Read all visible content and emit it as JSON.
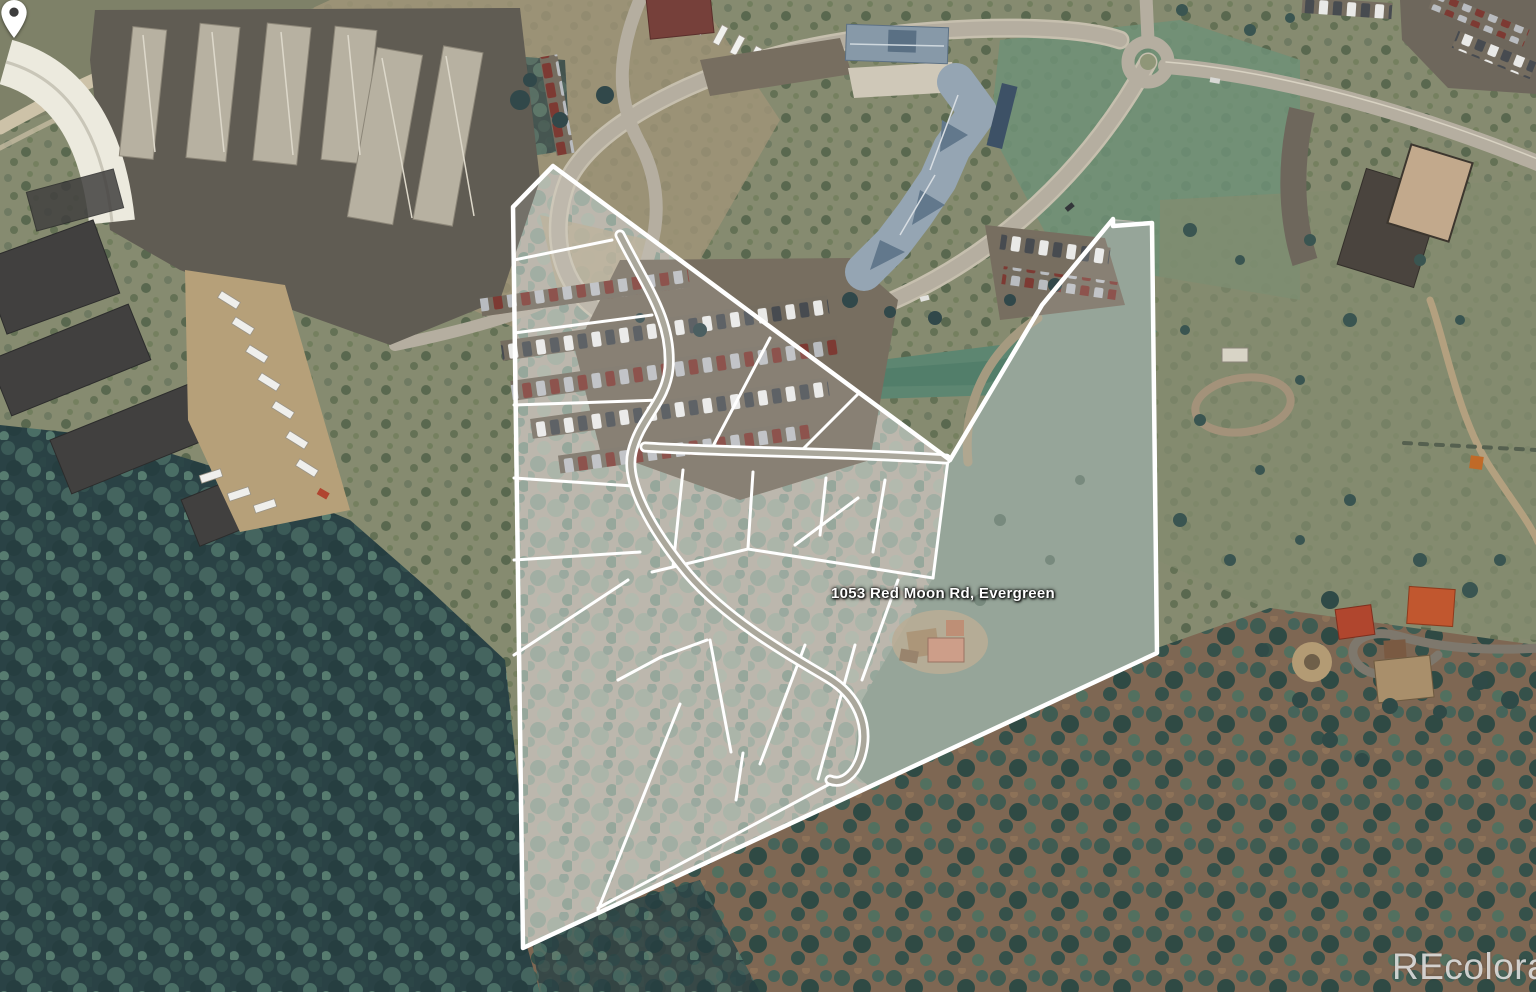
{
  "address_label": {
    "text": "1053 Red Moon Rd, Evergreen"
  },
  "watermark": {
    "text": "REcolorado"
  },
  "map": {
    "type": "satellite-aerial-photo",
    "overlay": {
      "boundary_color": "#ffffff",
      "lot_line_color": "#ffffff",
      "pin_color": "#ffffff",
      "pin_hole_color": "#3d3d3d",
      "label_color": "#ffffff"
    }
  }
}
